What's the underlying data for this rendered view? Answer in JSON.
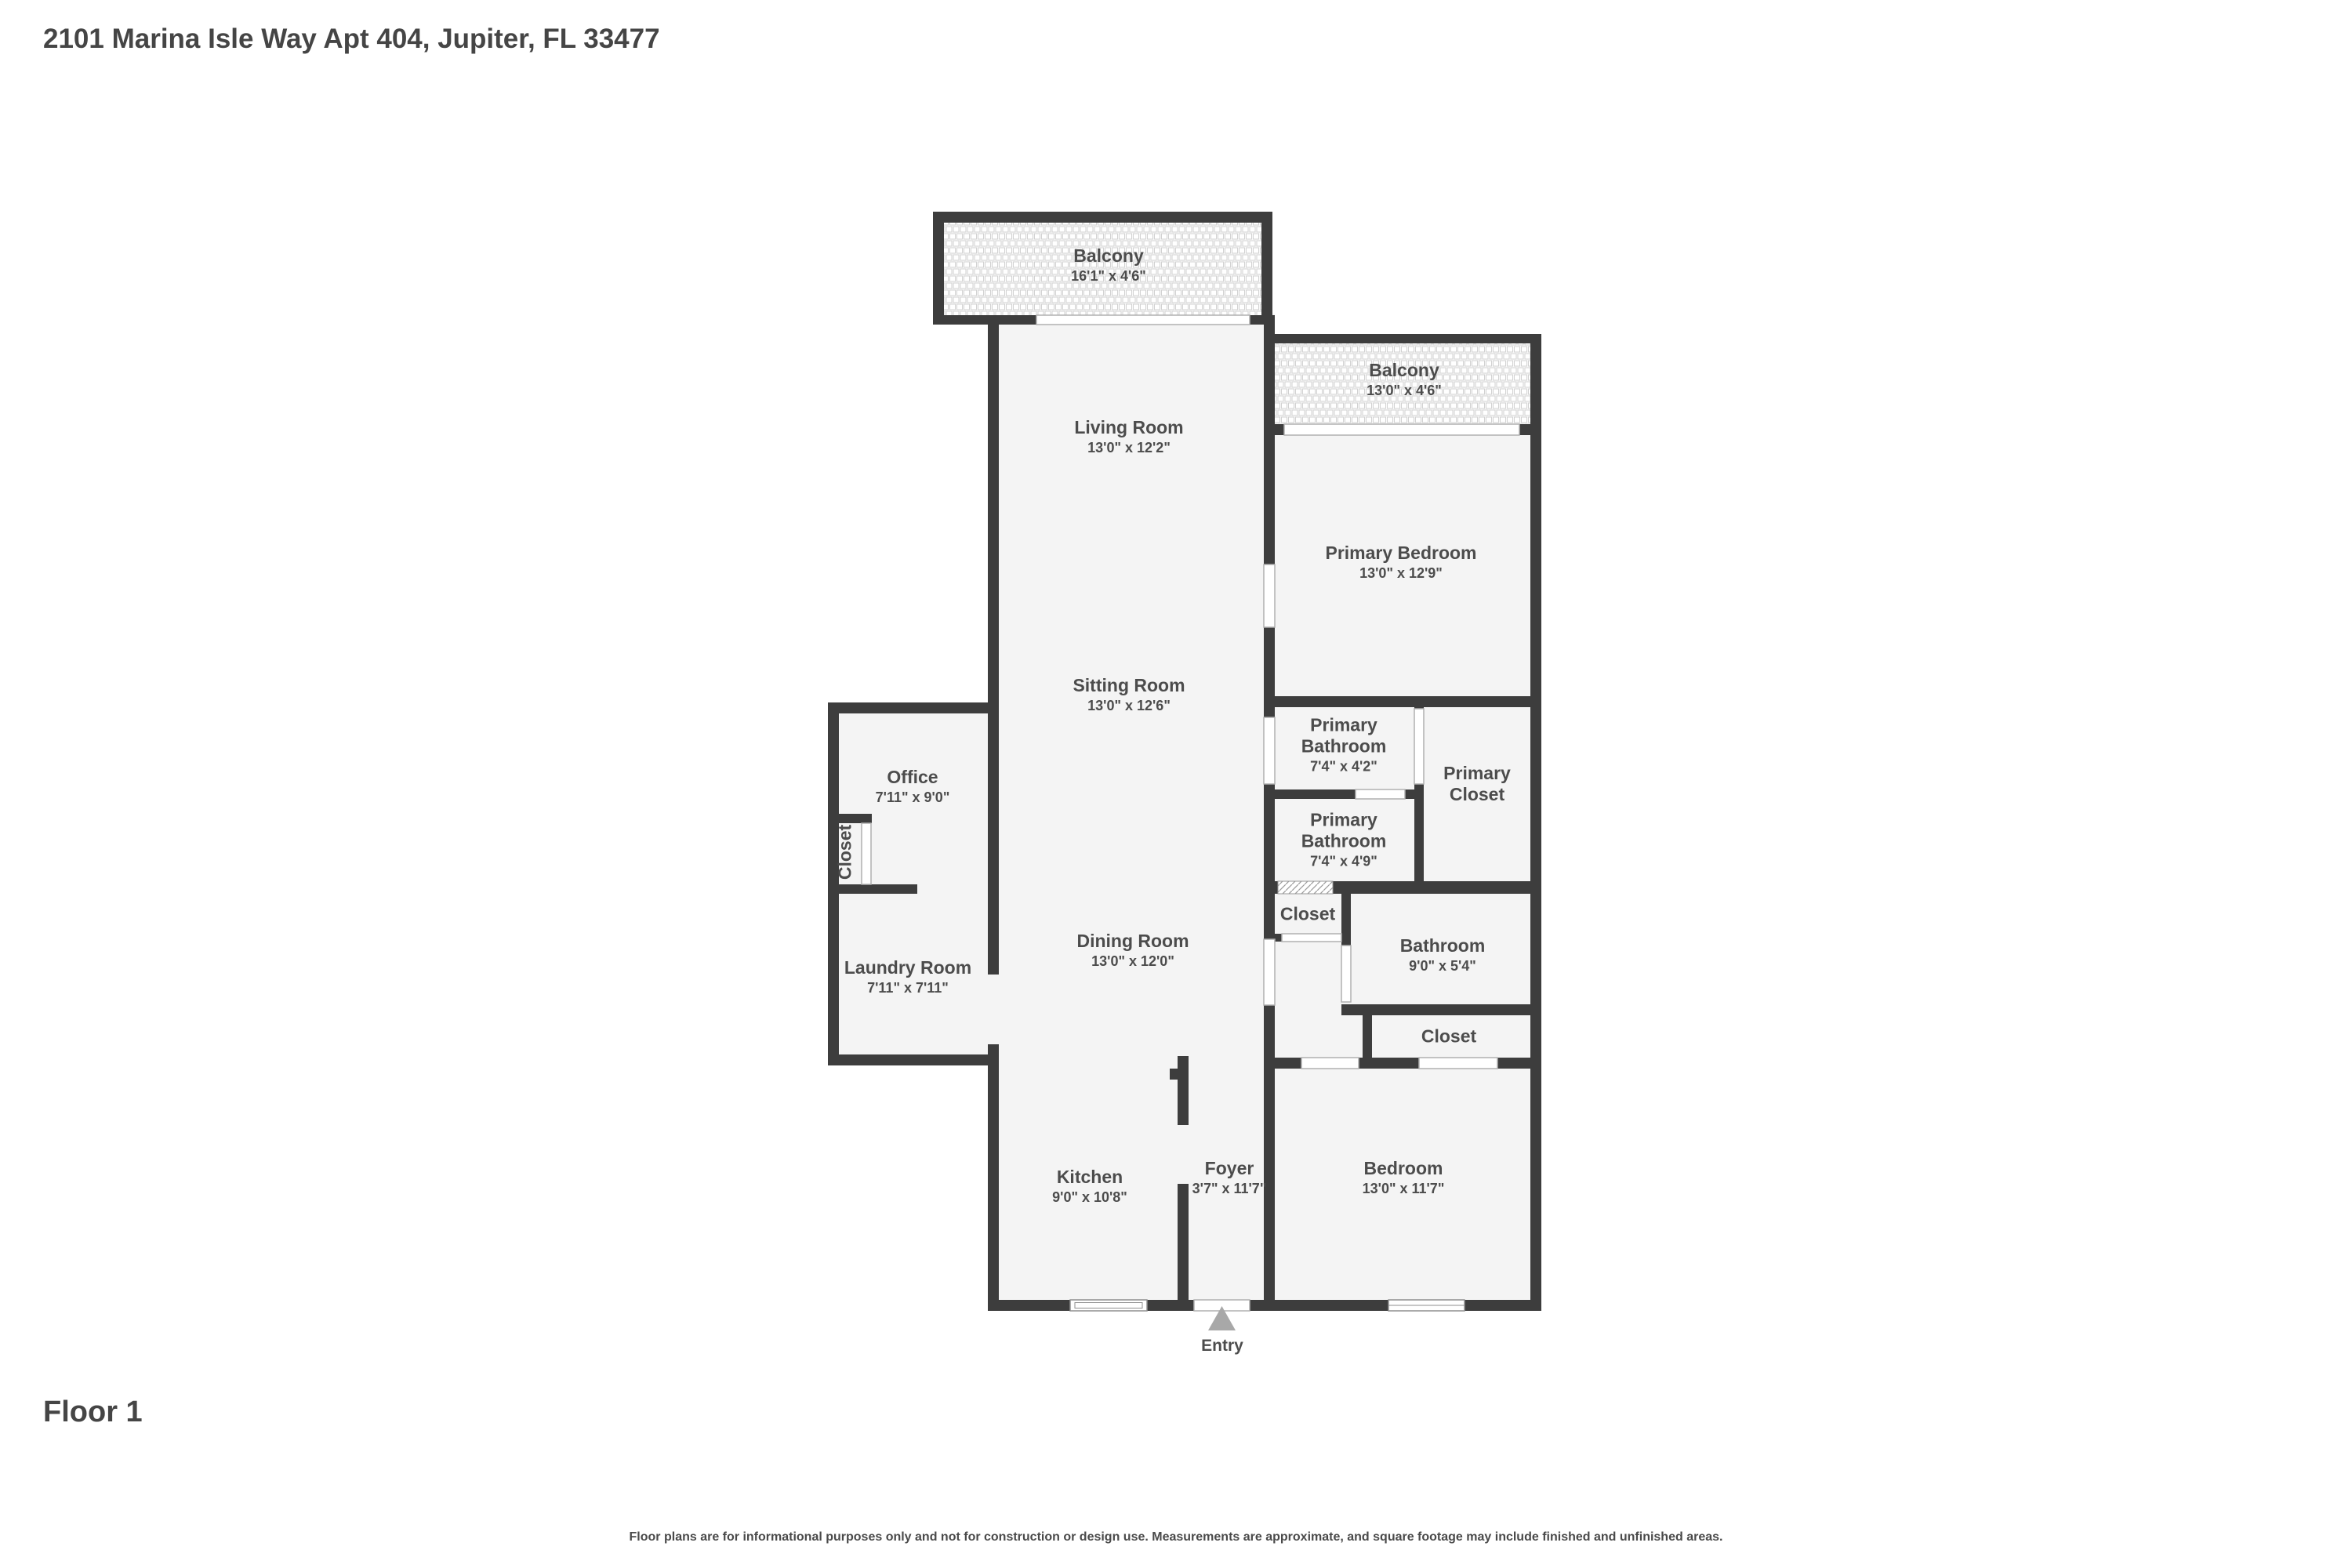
{
  "header": {
    "title": "2101 Marina Isle Way Apt 404, Jupiter, FL 33477"
  },
  "footer": {
    "floor_label": "Floor 1",
    "disclaimer": "Floor plans are for informational purposes only and not for construction or design use. Measurements are approximate, and square footage may include finished and unfinished areas."
  },
  "colors": {
    "wall": "#3d3d3d",
    "room_fill": "#f4f4f4",
    "text": "#4c4c4c",
    "entry_arrow": "#a8a8a8"
  },
  "plan": {
    "entry_label": "Entry",
    "rooms": [
      {
        "name": "Balcony",
        "dims": "16'1\" x 4'6\""
      },
      {
        "name": "Balcony",
        "dims": "13'0\" x 4'6\""
      },
      {
        "name": "Living Room",
        "dims": "13'0\" x 12'2\""
      },
      {
        "name": "Primary Bedroom",
        "dims": "13'0\" x 12'9\""
      },
      {
        "name": "Sitting Room",
        "dims": "13'0\" x 12'6\""
      },
      {
        "name": "Office",
        "dims": "7'11\" x 9'0\""
      },
      {
        "name": "Primary Bathroom",
        "dims": "7'4\" x 4'2\""
      },
      {
        "name": "Primary Closet",
        "dims": ""
      },
      {
        "name": "Primary Bathroom",
        "dims": "7'4\" x 4'9\""
      },
      {
        "name": "Closet",
        "dims": ""
      },
      {
        "name": "Laundry Room",
        "dims": "7'11\" x 7'11\""
      },
      {
        "name": "Dining Room",
        "dims": "13'0\" x 12'0\""
      },
      {
        "name": "Closet",
        "dims": ""
      },
      {
        "name": "Bathroom",
        "dims": "9'0\" x 5'4\""
      },
      {
        "name": "Closet",
        "dims": ""
      },
      {
        "name": "Bedroom",
        "dims": "13'0\" x 11'7\""
      },
      {
        "name": "Kitchen",
        "dims": "9'0\" x 10'8\""
      },
      {
        "name": "Foyer",
        "dims": "3'7\" x 11'7\""
      }
    ]
  }
}
